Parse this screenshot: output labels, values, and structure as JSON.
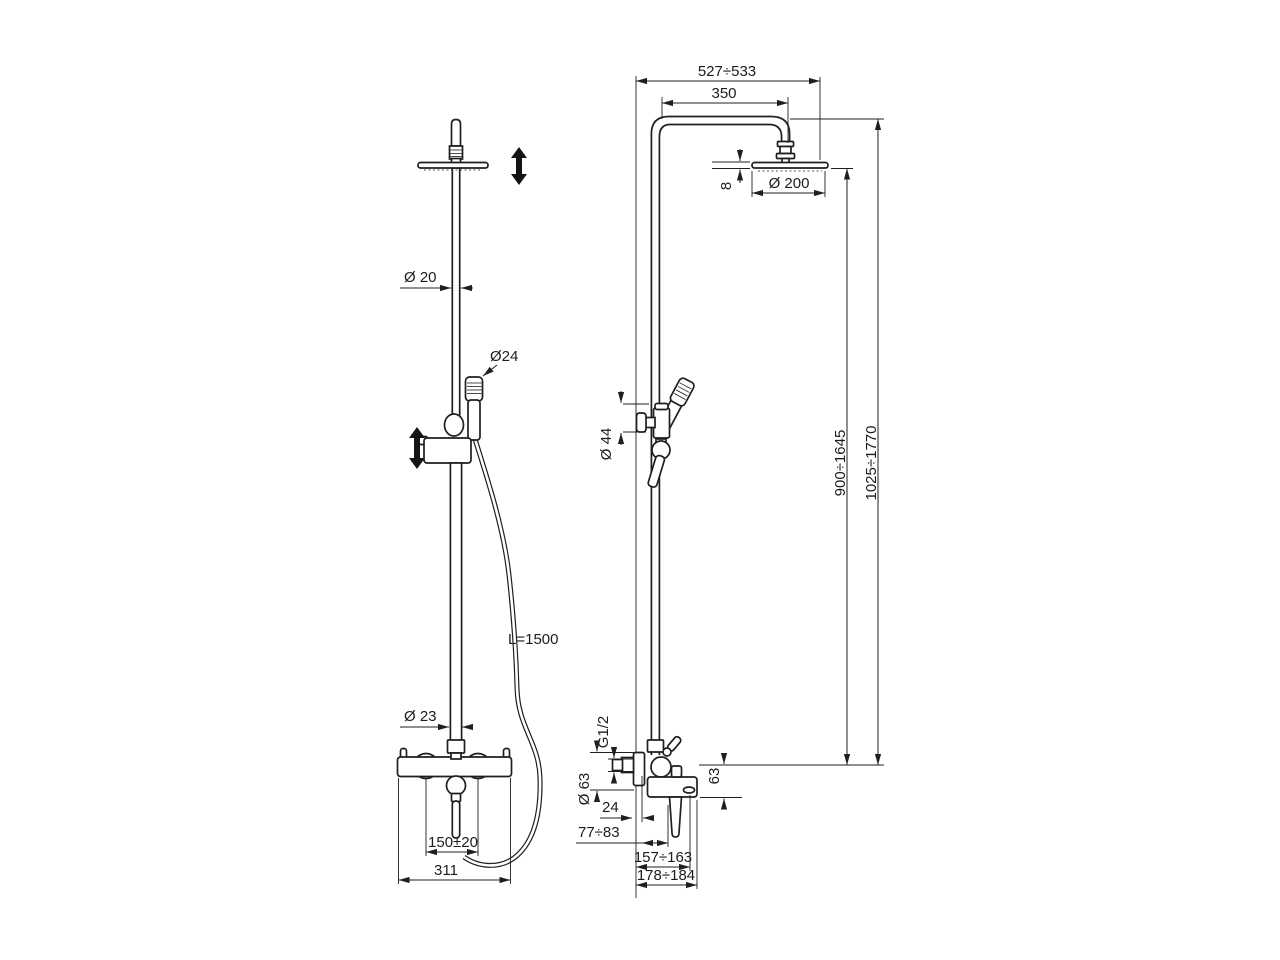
{
  "drawing": {
    "background": "#ffffff",
    "line_color": "#1f1f1f",
    "views": {
      "front": {
        "dims": {
          "upper_pipe_dia": "Ø 20",
          "handshower_dia": "Ø24",
          "hose_length": "L=1500",
          "lower_pipe_dia": "Ø 23",
          "inlet_spacing": "150±20",
          "body_width": "311"
        }
      },
      "side": {
        "dims": {
          "overall_depth": "527÷533",
          "arm_projection": "350",
          "head_dia": "Ø 200",
          "head_thickness": "8",
          "height_to_head": "900÷1645",
          "height_overall": "1025÷1770",
          "slider_dia": "Ø 44",
          "thread_size": "G1/2",
          "flange_dia": "Ø 63",
          "body_drop": "63",
          "wall_offset": "24",
          "lever_offset": "77÷83",
          "outlet_reach": "157÷163",
          "body_reach": "178÷184"
        }
      }
    }
  }
}
